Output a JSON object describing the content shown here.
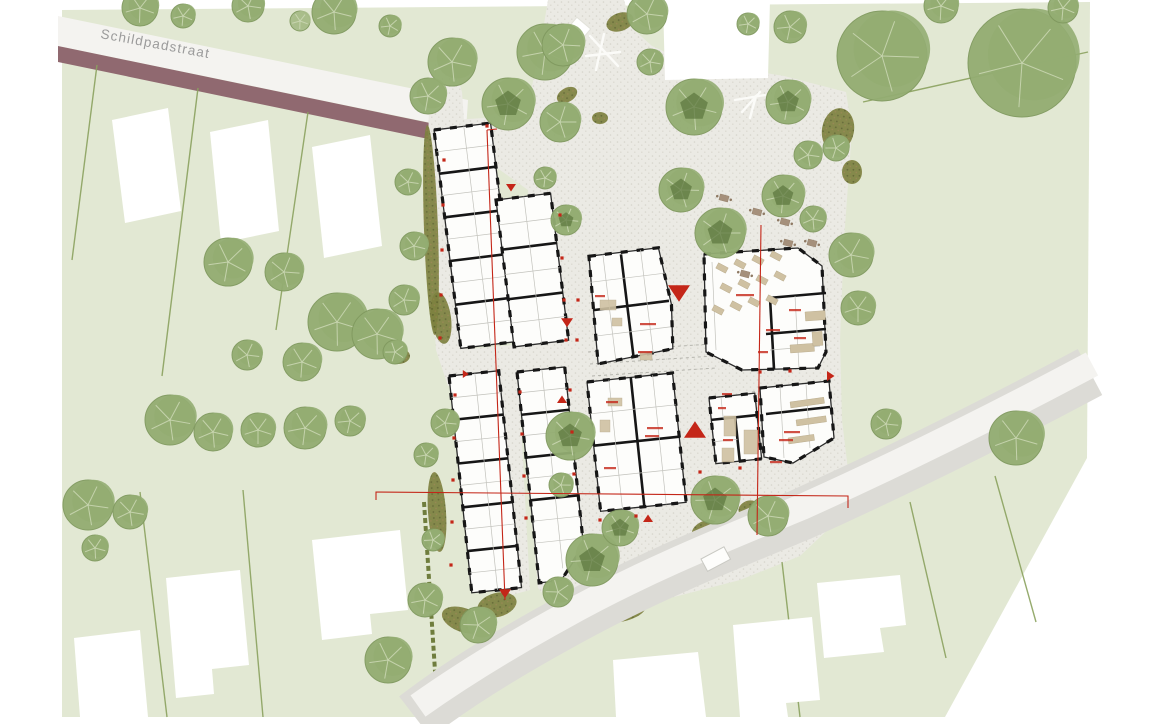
{
  "street": {
    "name": "Schildpadstraat"
  },
  "palette": {
    "paper": "#ffffff",
    "field": "#e2e8d3",
    "gravel": "#ebeae4",
    "gravelDot": "#d6d4cb",
    "roadWhite": "#f4f3f0",
    "roadGray": "#dcdbd6",
    "mauve": "#906970",
    "treeMid": "#93ad72",
    "treeLight": "#a8bc8a",
    "treeEdge": "#80995f",
    "treeInner": "#5f7a40",
    "branch": "#cdd9b6",
    "shrub": "#7d813f",
    "shrubDot": "#5c612c",
    "shrubDot2": "#93804a",
    "wall": "#161616",
    "furniture": "#cfc1a2",
    "furnitureBrown": "#a5907b",
    "red": "#c42618",
    "labelGray": "#9b9b9b",
    "parcelLine": "#8ba25f",
    "hedgeLine": "#6f7d3d"
  },
  "trees": [
    {
      "x": 140,
      "y": 8,
      "r": 18
    },
    {
      "x": 183,
      "y": 16,
      "r": 12
    },
    {
      "x": 248,
      "y": 6,
      "r": 16
    },
    {
      "x": 334,
      "y": 12,
      "r": 22
    },
    {
      "x": 300,
      "y": 21,
      "r": 10,
      "v": "l"
    },
    {
      "x": 390,
      "y": 26,
      "r": 11
    },
    {
      "x": 452,
      "y": 62,
      "r": 24
    },
    {
      "x": 545,
      "y": 52,
      "r": 28
    },
    {
      "x": 508,
      "y": 104,
      "r": 26,
      "i": 1
    },
    {
      "x": 560,
      "y": 122,
      "r": 20
    },
    {
      "x": 428,
      "y": 96,
      "r": 18
    },
    {
      "x": 563,
      "y": 45,
      "r": 21
    },
    {
      "x": 647,
      "y": 14,
      "r": 20
    },
    {
      "x": 650,
      "y": 62,
      "r": 13
    },
    {
      "x": 694,
      "y": 107,
      "r": 28,
      "i": 1
    },
    {
      "x": 748,
      "y": 24,
      "r": 11
    },
    {
      "x": 790,
      "y": 27,
      "r": 16
    },
    {
      "x": 788,
      "y": 102,
      "r": 22,
      "i": 1
    },
    {
      "x": 808,
      "y": 155,
      "r": 14
    },
    {
      "x": 836,
      "y": 148,
      "r": 13
    },
    {
      "x": 882,
      "y": 56,
      "r": 45
    },
    {
      "x": 1022,
      "y": 63,
      "r": 54
    },
    {
      "x": 941,
      "y": 6,
      "r": 17
    },
    {
      "x": 1063,
      "y": 8,
      "r": 15
    },
    {
      "x": 681,
      "y": 190,
      "r": 22,
      "i": 1
    },
    {
      "x": 720,
      "y": 233,
      "r": 25,
      "i": 1
    },
    {
      "x": 783,
      "y": 196,
      "r": 21,
      "i": 1
    },
    {
      "x": 813,
      "y": 219,
      "r": 13
    },
    {
      "x": 851,
      "y": 255,
      "r": 22
    },
    {
      "x": 858,
      "y": 308,
      "r": 17
    },
    {
      "x": 566,
      "y": 220,
      "r": 15,
      "i": 1
    },
    {
      "x": 545,
      "y": 178,
      "r": 11
    },
    {
      "x": 228,
      "y": 262,
      "r": 24
    },
    {
      "x": 284,
      "y": 272,
      "r": 19
    },
    {
      "x": 337,
      "y": 322,
      "r": 29
    },
    {
      "x": 377,
      "y": 334,
      "r": 25
    },
    {
      "x": 302,
      "y": 362,
      "r": 19
    },
    {
      "x": 247,
      "y": 355,
      "r": 15
    },
    {
      "x": 170,
      "y": 420,
      "r": 25
    },
    {
      "x": 213,
      "y": 432,
      "r": 19
    },
    {
      "x": 258,
      "y": 430,
      "r": 17
    },
    {
      "x": 305,
      "y": 428,
      "r": 21
    },
    {
      "x": 350,
      "y": 421,
      "r": 15
    },
    {
      "x": 408,
      "y": 182,
      "r": 13
    },
    {
      "x": 414,
      "y": 246,
      "r": 14
    },
    {
      "x": 404,
      "y": 300,
      "r": 15
    },
    {
      "x": 395,
      "y": 352,
      "r": 12
    },
    {
      "x": 88,
      "y": 505,
      "r": 25
    },
    {
      "x": 130,
      "y": 512,
      "r": 17
    },
    {
      "x": 95,
      "y": 548,
      "r": 13
    },
    {
      "x": 445,
      "y": 423,
      "r": 14
    },
    {
      "x": 426,
      "y": 455,
      "r": 12
    },
    {
      "x": 433,
      "y": 540,
      "r": 11
    },
    {
      "x": 570,
      "y": 436,
      "r": 24,
      "i": 1
    },
    {
      "x": 561,
      "y": 485,
      "r": 12
    },
    {
      "x": 592,
      "y": 560,
      "r": 26,
      "i": 1
    },
    {
      "x": 558,
      "y": 592,
      "r": 15
    },
    {
      "x": 478,
      "y": 625,
      "r": 18
    },
    {
      "x": 425,
      "y": 600,
      "r": 17
    },
    {
      "x": 388,
      "y": 660,
      "r": 23
    },
    {
      "x": 715,
      "y": 500,
      "r": 24,
      "i": 1
    },
    {
      "x": 768,
      "y": 516,
      "r": 20
    },
    {
      "x": 620,
      "y": 528,
      "r": 18,
      "i": 1
    },
    {
      "x": 1016,
      "y": 438,
      "r": 27
    },
    {
      "x": 886,
      "y": 424,
      "r": 15
    }
  ],
  "shrubs": [
    {
      "x": 431,
      "y": 230,
      "rx": 7,
      "ry": 105,
      "rot": -2
    },
    {
      "x": 441,
      "y": 318,
      "rx": 10,
      "ry": 26,
      "rot": -8
    },
    {
      "x": 398,
      "y": 356,
      "rx": 12,
      "ry": 8,
      "rot": 0
    },
    {
      "x": 437,
      "y": 512,
      "rx": 9,
      "ry": 40,
      "rot": -4
    },
    {
      "x": 463,
      "y": 620,
      "rx": 22,
      "ry": 12,
      "rot": 20
    },
    {
      "x": 497,
      "y": 605,
      "rx": 20,
      "ry": 12,
      "rot": -15
    },
    {
      "x": 560,
      "y": 512,
      "rx": 12,
      "ry": 16,
      "rot": 25
    },
    {
      "x": 570,
      "y": 540,
      "rx": 8,
      "ry": 12,
      "rot": 15
    },
    {
      "x": 620,
      "y": 612,
      "rx": 26,
      "ry": 10,
      "rot": -12
    },
    {
      "x": 585,
      "y": 625,
      "rx": 14,
      "ry": 8,
      "rot": -12
    },
    {
      "x": 838,
      "y": 130,
      "rx": 16,
      "ry": 22,
      "rot": 10
    },
    {
      "x": 852,
      "y": 172,
      "rx": 10,
      "ry": 12,
      "rot": 0
    },
    {
      "x": 620,
      "y": 22,
      "rx": 14,
      "ry": 9,
      "rot": -20
    },
    {
      "x": 567,
      "y": 95,
      "rx": 11,
      "ry": 7,
      "rot": -30
    },
    {
      "x": 600,
      "y": 118,
      "rx": 8,
      "ry": 6,
      "rot": 0
    },
    {
      "x": 705,
      "y": 530,
      "rx": 14,
      "ry": 9,
      "rot": -25
    },
    {
      "x": 748,
      "y": 508,
      "rx": 10,
      "ry": 7,
      "rot": -25
    }
  ],
  "parcel_lines": [
    {
      "x1": 97,
      "y1": 65,
      "x2": 72,
      "y2": 260
    },
    {
      "x1": 198,
      "y1": 88,
      "x2": 162,
      "y2": 376
    },
    {
      "x1": 308,
      "y1": 112,
      "x2": 276,
      "y2": 330
    },
    {
      "x1": 140,
      "y1": 492,
      "x2": 167,
      "y2": 717
    },
    {
      "x1": 243,
      "y1": 490,
      "x2": 263,
      "y2": 717
    },
    {
      "x1": 863,
      "y1": 102,
      "x2": 1088,
      "y2": 52
    },
    {
      "x1": 782,
      "y1": 562,
      "x2": 800,
      "y2": 717
    },
    {
      "x1": 910,
      "y1": 502,
      "x2": 946,
      "y2": 658
    },
    {
      "x1": 995,
      "y1": 476,
      "x2": 1036,
      "y2": 622
    }
  ],
  "hedge_rows": [
    {
      "x1": 424,
      "y1": 502,
      "x2": 438,
      "y2": 717
    }
  ],
  "neighbor_houses": [
    {
      "pts": "112,120 168,108 181,211 125,223"
    },
    {
      "pts": "210,132 268,120 279,231 221,243"
    },
    {
      "pts": "312,147 370,135 382,246 324,258"
    },
    {
      "pts": "74,638 140,630 148,717 80,717"
    },
    {
      "pts": "166,578 240,570 249,665 212,669 214,694 176,698"
    },
    {
      "pts": "312,540 400,530 408,610 370,614 372,634 322,640"
    },
    {
      "pts": "817,583 900,575 906,625 880,628 884,652 824,658"
    },
    {
      "pts": "733,625 812,617 820,700 786,703 788,717 740,717"
    },
    {
      "pts": "613,660 698,652 706,717 616,717"
    },
    {
      "pts": "663,0 770,0 768,78 665,80"
    }
  ],
  "section_lines": [
    {
      "pts": "487,130 505,600"
    },
    {
      "pts": "487,130 497,129"
    },
    {
      "pts": "761,225 757,535"
    },
    {
      "pts": "376,500 376,492 848,496 848,508"
    }
  ],
  "red_triangles": [
    {
      "x": 679,
      "y": 294,
      "s": 11,
      "dir": "down"
    },
    {
      "x": 567,
      "y": 323,
      "s": 6,
      "dir": "down"
    },
    {
      "x": 695,
      "y": 429,
      "s": 11,
      "dir": "up"
    },
    {
      "x": 562,
      "y": 399,
      "s": 5,
      "dir": "up"
    },
    {
      "x": 511,
      "y": 188,
      "s": 5,
      "dir": "down"
    },
    {
      "x": 648,
      "y": 518,
      "s": 5,
      "dir": "up"
    },
    {
      "x": 831,
      "y": 376,
      "s": 5,
      "dir": "right"
    },
    {
      "x": 505,
      "y": 594,
      "s": 6,
      "dir": "down"
    },
    {
      "x": 466,
      "y": 374,
      "s": 4,
      "dir": "right"
    }
  ],
  "red_dots": [
    [
      444,
      160
    ],
    [
      443,
      205
    ],
    [
      442,
      250
    ],
    [
      441,
      295
    ],
    [
      440,
      338
    ],
    [
      560,
      215
    ],
    [
      562,
      258
    ],
    [
      564,
      300
    ],
    [
      566,
      340
    ],
    [
      455,
      395
    ],
    [
      454,
      438
    ],
    [
      453,
      480
    ],
    [
      452,
      522
    ],
    [
      451,
      565
    ],
    [
      520,
      392
    ],
    [
      522,
      434
    ],
    [
      524,
      476
    ],
    [
      526,
      518
    ],
    [
      570,
      390
    ],
    [
      572,
      432
    ],
    [
      574,
      474
    ],
    [
      600,
      520
    ],
    [
      636,
      516
    ],
    [
      578,
      300
    ],
    [
      577,
      340
    ],
    [
      760,
      372
    ],
    [
      790,
      371
    ],
    [
      700,
      472
    ],
    [
      740,
      468
    ],
    [
      487,
      126
    ]
  ],
  "micro_labels": [
    {
      "x": 648,
      "y": 324,
      "w": 16
    },
    {
      "x": 645,
      "y": 352,
      "w": 14
    },
    {
      "x": 600,
      "y": 296,
      "w": 10
    },
    {
      "x": 745,
      "y": 295,
      "w": 18
    },
    {
      "x": 773,
      "y": 330,
      "w": 14
    },
    {
      "x": 800,
      "y": 338,
      "w": 12
    },
    {
      "x": 763,
      "y": 352,
      "w": 10
    },
    {
      "x": 795,
      "y": 310,
      "w": 12
    },
    {
      "x": 612,
      "y": 402,
      "w": 12
    },
    {
      "x": 655,
      "y": 428,
      "w": 16
    },
    {
      "x": 652,
      "y": 436,
      "w": 14
    },
    {
      "x": 610,
      "y": 468,
      "w": 12
    },
    {
      "x": 727,
      "y": 394,
      "w": 10
    },
    {
      "x": 722,
      "y": 408,
      "w": 8
    },
    {
      "x": 728,
      "y": 440,
      "w": 10
    },
    {
      "x": 792,
      "y": 432,
      "w": 16
    },
    {
      "x": 786,
      "y": 440,
      "w": 14
    },
    {
      "x": 776,
      "y": 462,
      "w": 12
    }
  ],
  "hall_tables": [
    [
      722,
      268
    ],
    [
      740,
      264
    ],
    [
      758,
      260
    ],
    [
      776,
      256
    ],
    [
      726,
      288
    ],
    [
      744,
      284
    ],
    [
      762,
      280
    ],
    [
      780,
      276
    ],
    [
      718,
      310
    ],
    [
      736,
      306
    ],
    [
      754,
      302
    ],
    [
      772,
      300
    ]
  ],
  "hall_counters": [
    {
      "x": 805,
      "y": 312,
      "w": 20,
      "h": 9
    },
    {
      "x": 790,
      "y": 345,
      "w": 24,
      "h": 8
    },
    {
      "x": 812,
      "y": 332,
      "w": 10,
      "h": 14
    }
  ],
  "plaza_tables": [
    [
      724,
      198
    ],
    [
      757,
      212
    ],
    [
      785,
      222
    ],
    [
      788,
      243
    ],
    [
      812,
      243
    ],
    [
      745,
      274
    ]
  ],
  "long_tables": [
    {
      "x": 790,
      "y": 402,
      "w": 34,
      "h": 6
    },
    {
      "x": 796,
      "y": 420,
      "w": 30,
      "h": 6
    },
    {
      "x": 788,
      "y": 438,
      "w": 26,
      "h": 6
    }
  ],
  "small_furniture": [
    {
      "x": 600,
      "y": 300,
      "w": 16,
      "h": 10
    },
    {
      "x": 612,
      "y": 318,
      "w": 10,
      "h": 8
    },
    {
      "x": 640,
      "y": 352,
      "w": 12,
      "h": 8
    },
    {
      "x": 608,
      "y": 398,
      "w": 14,
      "h": 8
    },
    {
      "x": 600,
      "y": 420,
      "w": 10,
      "h": 12
    },
    {
      "x": 724,
      "y": 416,
      "w": 12,
      "h": 20
    },
    {
      "x": 722,
      "y": 448,
      "w": 12,
      "h": 14
    },
    {
      "x": 744,
      "y": 430,
      "w": 14,
      "h": 24
    }
  ]
}
